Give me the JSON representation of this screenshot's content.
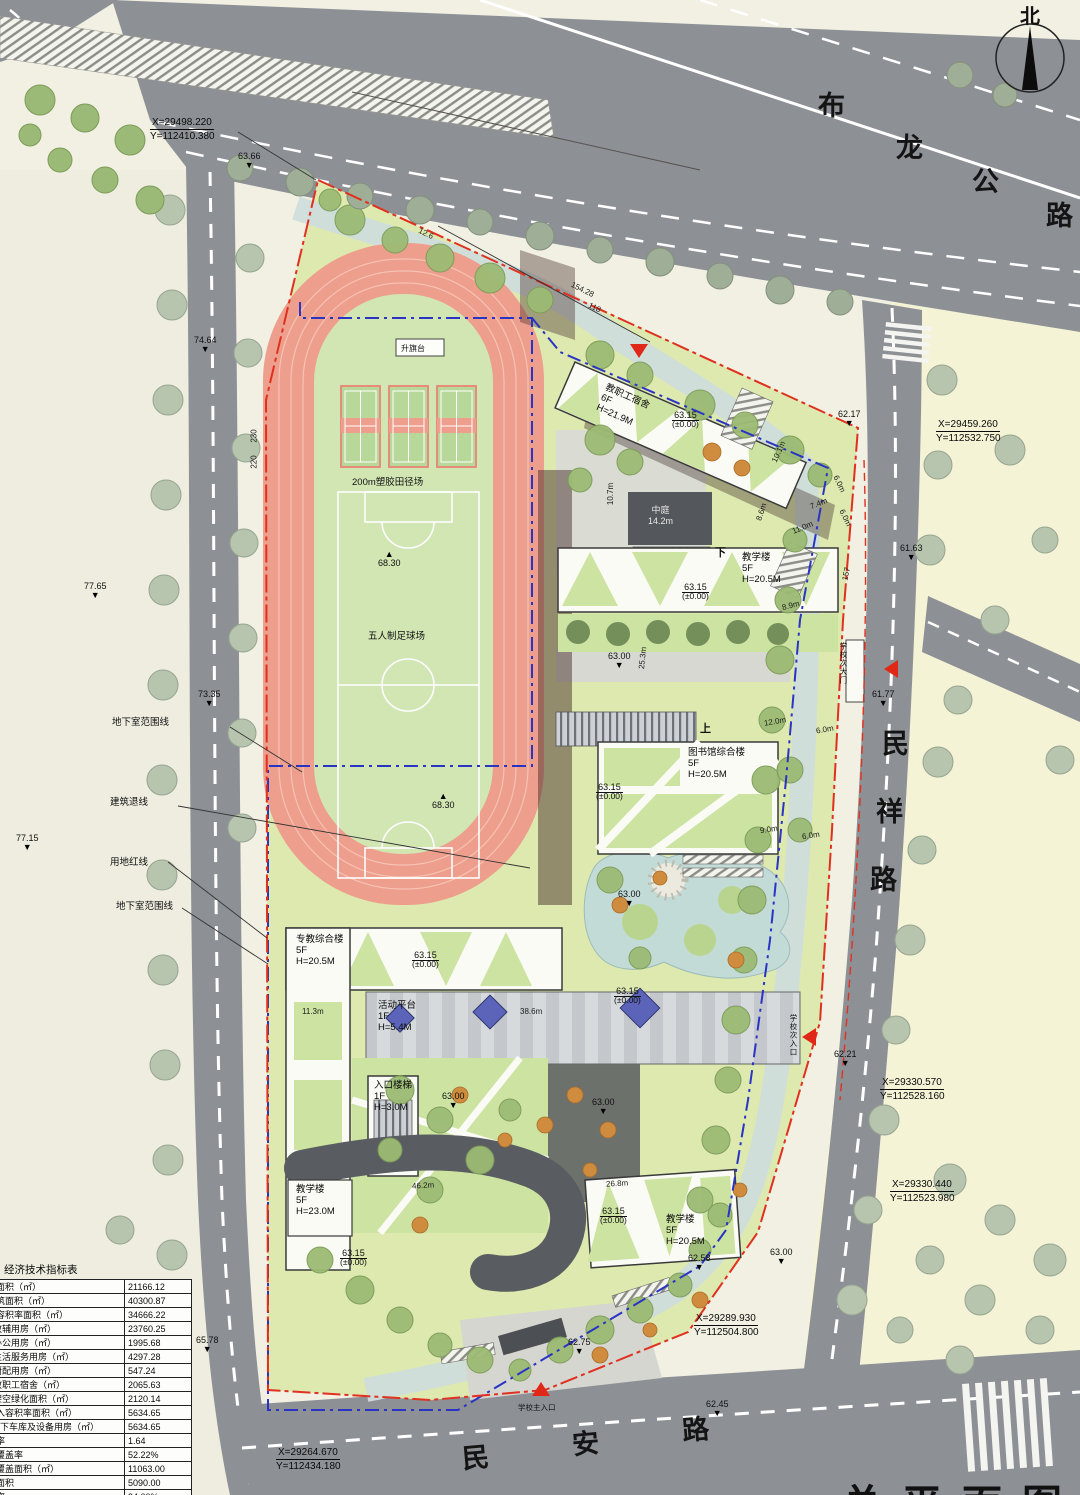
{
  "drawing": {
    "title": "总平面图",
    "compass_label": "北"
  },
  "roads": [
    {
      "name": "布龙公路",
      "chars": [
        "布",
        "龙",
        "公",
        "路"
      ]
    },
    {
      "name": "民祥路",
      "chars": [
        "民",
        "祥",
        "路"
      ]
    },
    {
      "name": "民安路",
      "chars": [
        "民",
        "安",
        "路"
      ]
    }
  ],
  "site": {
    "track_label": "200m塑胶田径场",
    "soccer_label": "五人制足球场",
    "flag_label": "升旗台",
    "atrium_label": "中庭",
    "atrium_dim": "14.2m",
    "up_label": "上",
    "down_label": "下"
  },
  "buildings": [
    {
      "name": "教职工宿舍",
      "floors": "6F",
      "height": "H=21.9M"
    },
    {
      "name": "教学楼",
      "floors": "5F",
      "height": "H=20.5M"
    },
    {
      "name": "图书馆综合楼",
      "floors": "5F",
      "height": "H=20.5M"
    },
    {
      "name": "专教综合楼",
      "floors": "5F",
      "height": "H=20.5M"
    },
    {
      "name": "活动平台",
      "floors": "1F",
      "height": "H=5.4M"
    },
    {
      "name": "入口楼梯",
      "floors": "1F",
      "height": "H=3.0M"
    },
    {
      "name": "教学楼",
      "floors": "5F",
      "height": "H=23.0M"
    },
    {
      "name": "教学楼",
      "floors": "5F",
      "height": "H=20.5M"
    }
  ],
  "boundary_labels": [
    {
      "text": "地下室范围线",
      "x": 112,
      "y": 714
    },
    {
      "text": "建筑退线",
      "x": 110,
      "y": 794
    },
    {
      "text": "用地红线",
      "x": 110,
      "y": 854
    },
    {
      "text": "地下室范围线",
      "x": 116,
      "y": 898
    }
  ],
  "entrances": [
    {
      "label": "学校次大门",
      "lx": 838,
      "ly": 642,
      "vert": true,
      "tx": 882,
      "ty": 662,
      "rot": 270
    },
    {
      "label": "学校次入口",
      "lx": 788,
      "ly": 1014,
      "vert": true,
      "tx": 800,
      "ty": 1030,
      "rot": 270
    },
    {
      "label": "学校主入口",
      "lx": 518,
      "ly": 1402,
      "vert": false,
      "tx": 532,
      "ty": 1382,
      "rot": 0
    },
    {
      "label": "",
      "lx": 0,
      "ly": 0,
      "vert": false,
      "tx": 630,
      "ty": 344,
      "rot": 180
    }
  ],
  "spot_elevations": [
    {
      "v": "63.66",
      "x": 238,
      "y": 152
    },
    {
      "v": "74.64",
      "x": 194,
      "y": 336
    },
    {
      "v": "77.65",
      "x": 84,
      "y": 582
    },
    {
      "v": "73.35",
      "x": 198,
      "y": 690
    },
    {
      "v": "77.15",
      "x": 16,
      "y": 834
    },
    {
      "v": "65.78",
      "x": 196,
      "y": 1336
    },
    {
      "v": "62.17",
      "x": 838,
      "y": 410
    },
    {
      "v": "61.63",
      "x": 900,
      "y": 544
    },
    {
      "v": "61.77",
      "x": 872,
      "y": 690
    },
    {
      "v": "62.21",
      "x": 834,
      "y": 1050
    },
    {
      "v": "62.58",
      "x": 688,
      "y": 1254
    },
    {
      "v": "62.75",
      "x": 568,
      "y": 1338
    },
    {
      "v": "62.45",
      "x": 706,
      "y": 1400
    },
    {
      "v": "63.00",
      "x": 608,
      "y": 652
    },
    {
      "v": "63.00",
      "x": 618,
      "y": 890
    },
    {
      "v": "63.00",
      "x": 442,
      "y": 1092
    },
    {
      "v": "63.00",
      "x": 592,
      "y": 1098
    },
    {
      "v": "63.00",
      "x": 770,
      "y": 1248
    }
  ],
  "peak_elevations": [
    {
      "v": "68.30",
      "x": 378,
      "y": 550
    },
    {
      "v": "68.30",
      "x": 432,
      "y": 792
    }
  ],
  "level_markers": [
    {
      "v": "63.15",
      "sub": "(±0.00)",
      "x": 672,
      "y": 410
    },
    {
      "v": "63.15",
      "sub": "(±0.00)",
      "x": 682,
      "y": 582
    },
    {
      "v": "63.15",
      "sub": "(±0.00)",
      "x": 596,
      "y": 782
    },
    {
      "v": "63.15",
      "sub": "(±0.00)",
      "x": 412,
      "y": 950
    },
    {
      "v": "63.15",
      "sub": "(±0.00)",
      "x": 614,
      "y": 986
    },
    {
      "v": "63.15",
      "sub": "(±0.00)",
      "x": 600,
      "y": 1206
    },
    {
      "v": "63.15",
      "sub": "(±0.00)",
      "x": 340,
      "y": 1248
    }
  ],
  "dimensions": [
    {
      "t": "10.7m",
      "x": 600,
      "y": 490,
      "r": -90
    },
    {
      "t": "10.1m",
      "x": 768,
      "y": 448,
      "r": -66
    },
    {
      "t": "8.6m",
      "x": 753,
      "y": 508,
      "r": -72
    },
    {
      "t": "7.4m",
      "x": 810,
      "y": 500,
      "r": -22
    },
    {
      "t": "11.0m",
      "x": 792,
      "y": 524,
      "r": -22
    },
    {
      "t": "6.0m",
      "x": 830,
      "y": 480,
      "r": 64
    },
    {
      "t": "6.0m",
      "x": 836,
      "y": 514,
      "r": 64
    },
    {
      "t": "157",
      "x": 840,
      "y": 570,
      "r": -78
    },
    {
      "t": "8.9m",
      "x": 782,
      "y": 602,
      "r": -14
    },
    {
      "t": "12.0m",
      "x": 764,
      "y": 718,
      "r": -10
    },
    {
      "t": "6.0m",
      "x": 816,
      "y": 726,
      "r": -10
    },
    {
      "t": "9.0m",
      "x": 760,
      "y": 826,
      "r": -8
    },
    {
      "t": "6.0m",
      "x": 802,
      "y": 832,
      "r": -8
    },
    {
      "t": "25.3m",
      "x": 632,
      "y": 654,
      "r": -84
    },
    {
      "t": "11.3m",
      "x": 302,
      "y": 1008,
      "r": 0
    },
    {
      "t": "38.6m",
      "x": 520,
      "y": 1008,
      "r": 0
    },
    {
      "t": "46.2m",
      "x": 412,
      "y": 1182,
      "r": -3
    },
    {
      "t": "26.8m",
      "x": 606,
      "y": 1180,
      "r": -3
    },
    {
      "t": "154.28",
      "x": 570,
      "y": 286,
      "r": 26
    },
    {
      "t": "118",
      "x": 588,
      "y": 304,
      "r": 26
    },
    {
      "t": "230",
      "x": 248,
      "y": 432,
      "r": -90
    },
    {
      "t": "220",
      "x": 248,
      "y": 458,
      "r": -90
    },
    {
      "t": "12.6",
      "x": 418,
      "y": 230,
      "r": 26
    }
  ],
  "coordinates": [
    {
      "x_label": "X=29498.220",
      "y_label": "Y=112410.380",
      "px": 150,
      "py": 116
    },
    {
      "x_label": "X=29459.260",
      "y_label": "Y=112532.750",
      "px": 936,
      "py": 418
    },
    {
      "x_label": "X=29330.570",
      "y_label": "Y=112528.160",
      "px": 880,
      "py": 1076
    },
    {
      "x_label": "X=29330.440",
      "y_label": "Y=112523.980",
      "px": 890,
      "py": 1178
    },
    {
      "x_label": "X=29289.930",
      "y_label": "Y=112504.800",
      "px": 694,
      "py": 1312
    },
    {
      "x_label": "X=29264.670",
      "y_label": "Y=112434.180",
      "px": 276,
      "py": 1446
    }
  ],
  "table": {
    "title": "经济技术指标表",
    "group_label": "其中",
    "rows": [
      {
        "label": "用地面积（㎡）",
        "value": "21166.12",
        "kind": "span"
      },
      {
        "label": "总建筑面积（㎡）",
        "value": "40300.87",
        "kind": "span"
      },
      {
        "label": "计入容积率面积（㎡）",
        "value": "34666.22",
        "kind": "span"
      },
      {
        "label": "教辅用房（㎡）",
        "value": "23760.25",
        "kind": "grp-start"
      },
      {
        "label": "办公用房（㎡）",
        "value": "1995.68",
        "kind": "grp"
      },
      {
        "label": "生活服务用房（㎡）",
        "value": "4297.28",
        "kind": "grp"
      },
      {
        "label": "厨配用房（㎡）",
        "value": "547.24",
        "kind": "grp"
      },
      {
        "label": "教职工宿舍（㎡）",
        "value": "2065.63",
        "kind": "grp"
      },
      {
        "label": "架空绿化面积（㎡）",
        "value": "2120.14",
        "kind": "grp"
      },
      {
        "label": "不计入容积率面积（㎡）",
        "value": "5634.65",
        "kind": "span"
      },
      {
        "label": "地下车库及设备用房（㎡）",
        "value": "5634.65",
        "kind": "span-indent"
      },
      {
        "label": "容积率",
        "value": "1.64",
        "kind": "span"
      },
      {
        "label": "建筑覆盖率",
        "value": "52.22%",
        "kind": "span"
      },
      {
        "label": "建筑覆盖面积（㎡）",
        "value": "11063.00",
        "kind": "span"
      },
      {
        "label": "绿地面积",
        "value": "5090.00",
        "kind": "span"
      },
      {
        "label": "绿地率",
        "value": "24.00%",
        "kind": "span"
      }
    ]
  }
}
